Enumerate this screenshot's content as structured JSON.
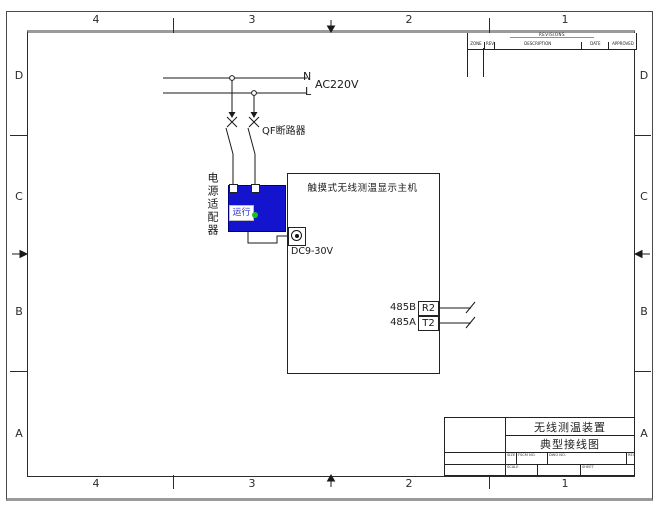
{
  "frame": {
    "zone_columns": [
      "4",
      "3",
      "2",
      "1"
    ],
    "zone_rows": [
      "D",
      "C",
      "B",
      "A"
    ]
  },
  "revision_table": {
    "title": "REVISIONS",
    "columns": [
      "ZONE",
      "REV",
      "DESCRIPTION",
      "DATE",
      "APPROVED"
    ]
  },
  "circuit": {
    "neutral_label": "N",
    "live_label": "L",
    "voltage_label": "AC220V",
    "breaker_label": "QF断路器",
    "adapter_label": "电源适配器",
    "adapter_status": "运行",
    "dc_input_label": "DC9-30V",
    "host_title": "触摸式无线测温显示主机",
    "terminals": [
      {
        "signal": "485B",
        "port": "R2"
      },
      {
        "signal": "485A",
        "port": "T2"
      }
    ]
  },
  "title_block": {
    "product": "无线测温装置",
    "drawing_type": "典型接线图",
    "size_label": "SIZE",
    "fscm_label": "FSCM NO.",
    "dwg_label": "DWG NO.",
    "rev_label": "REV",
    "scale_label": "SCALE",
    "sheet_label": "SHEET"
  },
  "colors": {
    "adapter_body": "#1414cf",
    "status_led": "#19c319",
    "status_text": "#2a2ad0",
    "line": "#1a1a1a",
    "frame_gray": "#9a9a9a"
  }
}
